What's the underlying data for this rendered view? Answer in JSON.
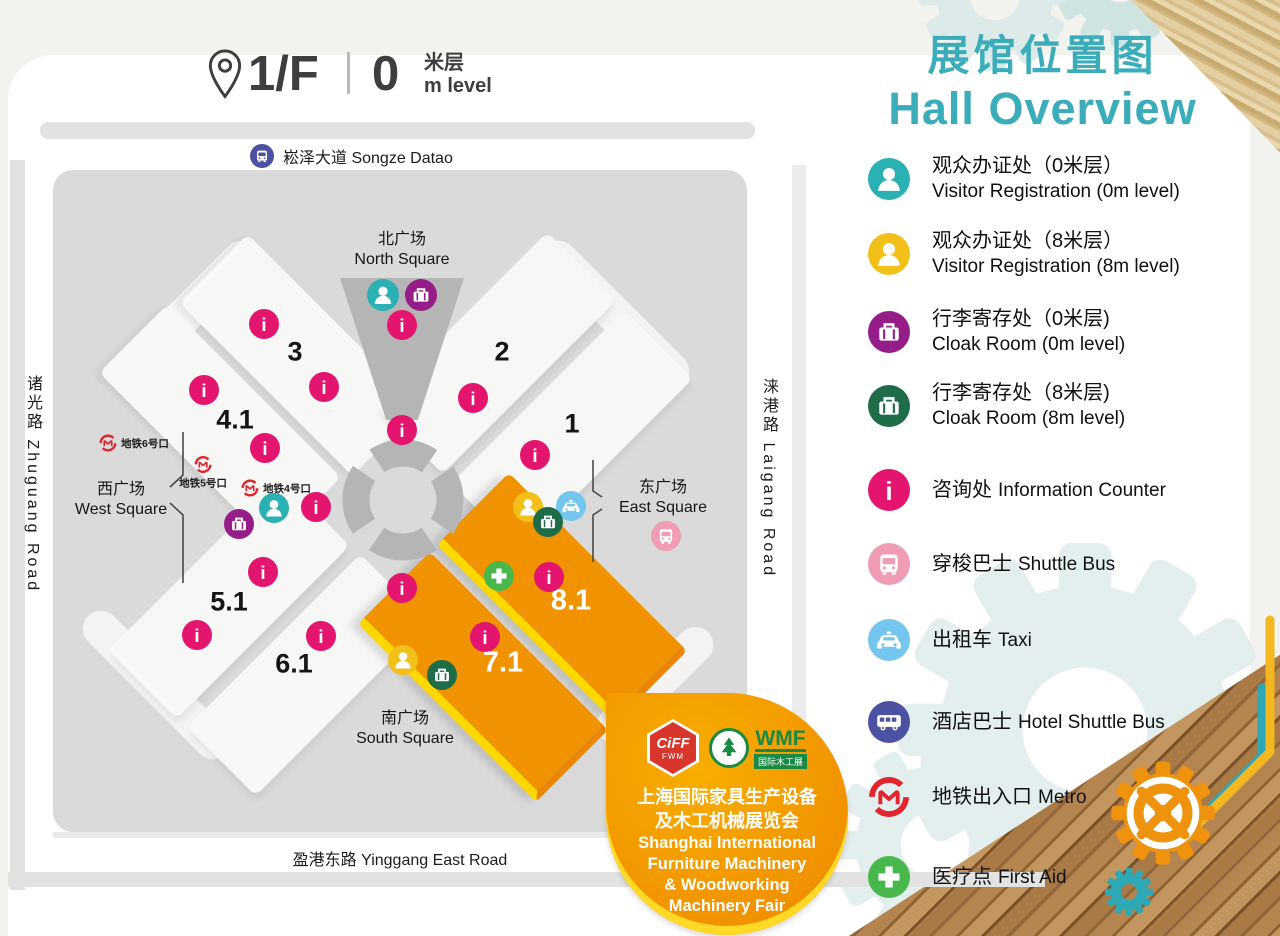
{
  "header": {
    "floor": "1/F",
    "level_value": "0",
    "level_unit_zh": "米层",
    "level_unit_en": "m level"
  },
  "title": {
    "zh": "展馆位置图",
    "en": "Hall Overview"
  },
  "roads": {
    "north": "崧泽大道 Songze Datao",
    "south": "盈港东路 Yinggang East Road",
    "west": "诸光路  Zhuguang Road",
    "east": "涞港路  Laigang Road"
  },
  "squares": {
    "north_zh": "北广场",
    "north_en": "North Square",
    "south_zh": "南广场",
    "south_en": "South Square",
    "west_zh": "西广场",
    "west_en": "West Square",
    "east_zh": "东广场",
    "east_en": "East Square"
  },
  "metro_exits": [
    {
      "label": "地铁6号口"
    },
    {
      "label": "地铁5号口"
    },
    {
      "label": "地铁4号口"
    }
  ],
  "map": {
    "halls": [
      {
        "id": "3"
      },
      {
        "id": "4.1"
      },
      {
        "id": "2"
      },
      {
        "id": "1"
      },
      {
        "id": "5.1"
      },
      {
        "id": "6.1"
      },
      {
        "id": "8.1"
      },
      {
        "id": "7.1"
      }
    ],
    "highlighted_halls": "7.1, 8.1"
  },
  "legend": {
    "items": [
      {
        "icon": "visitor-registration-0m",
        "color": "#2bb0b4",
        "zh": "观众办证处（0米层）",
        "en": "Visitor Registration (0m level)"
      },
      {
        "icon": "visitor-registration-8m",
        "color": "#f2c018",
        "zh": "观众办证处（8米层）",
        "en": "Visitor Registration (8m level)"
      },
      {
        "icon": "cloak-room-0m",
        "color": "#951d87",
        "zh": "行李寄存处（0米层)",
        "en": "Cloak Room (0m level)"
      },
      {
        "icon": "cloak-room-8m",
        "color": "#1e6c48",
        "zh": "行李寄存处（8米层)",
        "en": "Cloak Room (8m level)"
      },
      {
        "icon": "information-counter",
        "color": "#e4156e",
        "zh": "咨询处",
        "en": "Information Counter"
      },
      {
        "icon": "shuttle-bus",
        "color": "#f09cb5",
        "zh": "穿梭巴士",
        "en": "Shuttle Bus"
      },
      {
        "icon": "taxi",
        "color": "#74c6ee",
        "zh": "出租车",
        "en": "Taxi"
      },
      {
        "icon": "hotel-shuttle-bus",
        "color": "#4c51a2",
        "zh": "酒店巴士",
        "en": "Hotel Shuttle Bus"
      },
      {
        "icon": "metro",
        "color": "#e2242d",
        "zh": "地铁出入口",
        "en": "Metro"
      },
      {
        "icon": "first-aid",
        "color": "#48b74c",
        "zh": "医疗点",
        "en": "First Aid"
      }
    ]
  },
  "badge": {
    "ciff_name": "CiFF",
    "ciff_sub": "FWM",
    "wmf_name": "WMF",
    "wmf_sub": "国际木工展",
    "zh1": "上海国际家具生产设备",
    "zh2": "及木工机械展览会",
    "en1": "Shanghai International",
    "en2": "Furniture Machinery",
    "en3": "& Woodworking",
    "en4": "Machinery Fair"
  },
  "colors": {
    "accent_teal": "#3aacba",
    "hall_orange": "#f19200",
    "hall_edge_yellow": "#ffd800",
    "info_crimson": "#e4156e",
    "map_gray": "#dadada",
    "map_dark_gray": "#b5b5b5"
  }
}
